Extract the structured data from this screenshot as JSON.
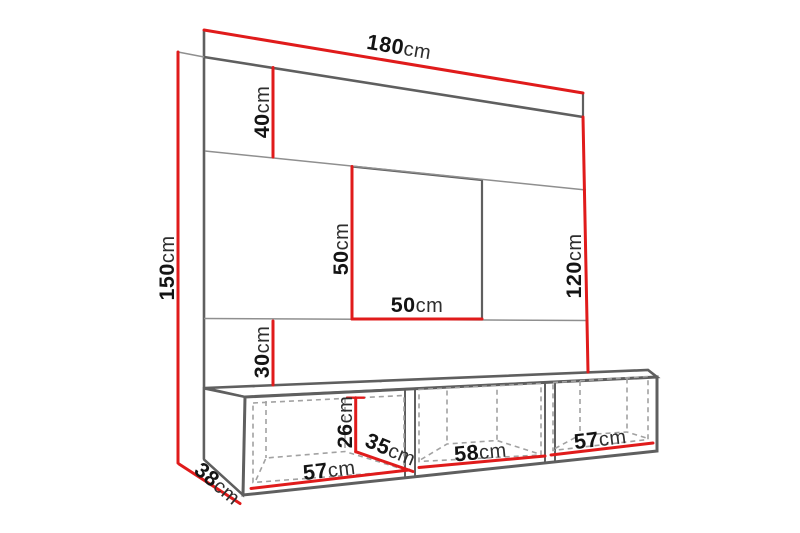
{
  "diagram": {
    "kind": "furniture-dimension-diagram",
    "colors": {
      "dimension": "#e01b1b",
      "edge": "#5f5f5f",
      "edge_light": "#8f8f8f",
      "hidden": "#a2a2a2",
      "text": "#141414",
      "background": "#ffffff"
    },
    "dimensions": {
      "width_total": {
        "value": "180",
        "unit": "cm"
      },
      "height_total": {
        "value": "150",
        "unit": "cm"
      },
      "top_shelf_height": {
        "value": "40",
        "unit": "cm"
      },
      "niche_height": {
        "value": "50",
        "unit": "cm"
      },
      "niche_width": {
        "value": "50",
        "unit": "cm"
      },
      "right_panel_height": {
        "value": "120",
        "unit": "cm"
      },
      "bottom_shelf_height": {
        "value": "30",
        "unit": "cm"
      },
      "cabinet_inner_height": {
        "value": "26",
        "unit": "cm"
      },
      "cabinet_inner_depth": {
        "value": "35",
        "unit": "cm"
      },
      "cabinet_depth": {
        "value": "38",
        "unit": "cm"
      },
      "compartment_left": {
        "value": "57",
        "unit": "cm"
      },
      "compartment_middle": {
        "value": "58",
        "unit": "cm"
      },
      "compartment_right": {
        "value": "57",
        "unit": "cm"
      }
    }
  }
}
